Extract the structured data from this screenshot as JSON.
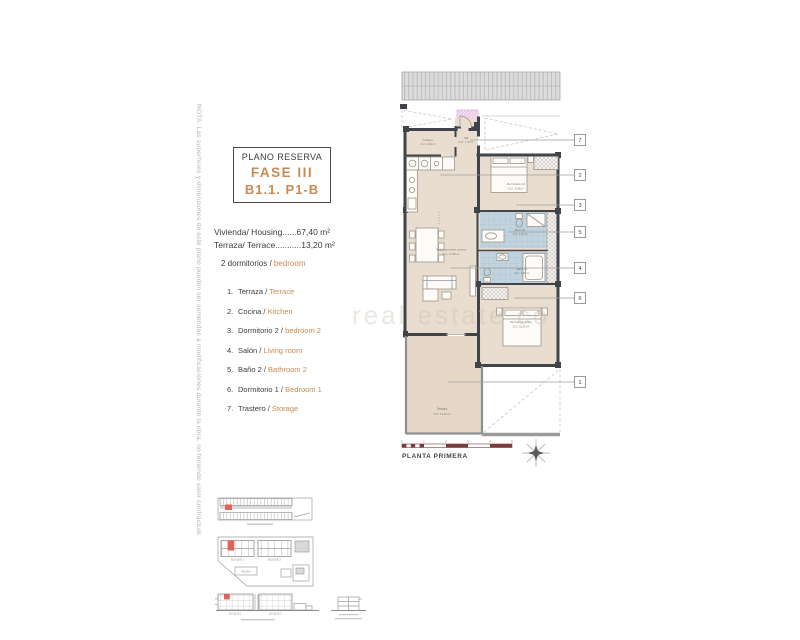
{
  "note": "NOTA: Las superficies y dimensiones de este plano pueden ser sometidas a modificaciones durante la obra, no teniendo valor contractual.",
  "title_block": {
    "subtitle": "PLANO RESERVA",
    "phase": "FASE III",
    "unit": "B1.1. P1-B"
  },
  "summary": {
    "housing": "Vivienda/ Housing......67,40 m²",
    "terrace": "Terraza/ Terrace...........13,20 m²",
    "bedrooms_es": "2 dormitorios / ",
    "bedrooms_en": "bedroom"
  },
  "legend": [
    {
      "num": "1.",
      "es": "Terraza / ",
      "en": "Terrace"
    },
    {
      "num": "2.",
      "es": "Cocina / ",
      "en": "Kitchen"
    },
    {
      "num": "3.",
      "es": "Dormitorio 2 / ",
      "en": "bedroom 2"
    },
    {
      "num": "4.",
      "es": "Salón / ",
      "en": "Living room"
    },
    {
      "num": "5.",
      "es": "Baño 2 / ",
      "en": "Bathroom 2"
    },
    {
      "num": "6.",
      "es": "Dormitorio 1 / ",
      "en": "Bedroom 1"
    },
    {
      "num": "7.",
      "es": "Trastero / ",
      "en": "Storage"
    }
  ],
  "plan": {
    "rooms": {
      "trastero": {
        "name": "Trastero",
        "area": "S.U.: 1.80 m²"
      },
      "hall": {
        "name": "hall",
        "area": "S.U.: 1.70 m²"
      },
      "dorm2": {
        "name": "Dormitorio 02",
        "area": "S.U.: 9.28 m²"
      },
      "bath2": {
        "name": "Baño 02",
        "area": "S.U.: 3.28 m²"
      },
      "bath1": {
        "name": "Baño 01",
        "area": "S.U.: 3.60 m²"
      },
      "salon": {
        "name": "Salón comedor cocina",
        "area": "S.U.: 27.80 m²"
      },
      "suite": {
        "name": "Dormitorio Suite",
        "area": "S.U.: 11.20 m²"
      },
      "terraza": {
        "name": "Terraza",
        "area": "S.U.: 13.20 m²"
      }
    },
    "markers": {
      "m7": "7",
      "m2": "2",
      "m3": "3",
      "m5": "5",
      "m4": "4",
      "m6": "6",
      "m1": "1"
    },
    "scale_ticks": {
      "t0": "0",
      "t1": "1",
      "t2": "2",
      "t3": "3",
      "t4": "4",
      "t5": "5"
    },
    "caption": "PLANTA PRIMERA"
  },
  "watermark": "real estate co",
  "site": {
    "bloque1": "BLOQUE 1",
    "bloque2": "BLOQUE 2",
    "piscina": "PISCINA"
  },
  "colors": {
    "accent_orange": "#c98a52",
    "wall_dark": "#3f444a",
    "floor_beige": "#e9ddd0",
    "bath_blue": "#c0d3de",
    "highlight_red": "#e0635a",
    "scale_red": "#7a3b3b",
    "magenta": "#dd9fd4"
  }
}
